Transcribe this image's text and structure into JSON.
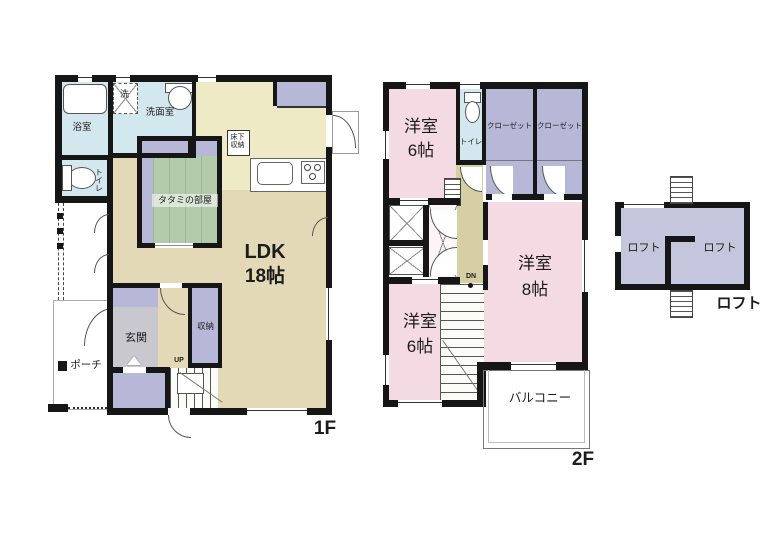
{
  "title": "floor-plan",
  "floor1": {
    "label": "1F",
    "bath": "浴室",
    "washer": "洗",
    "washroom": "洗面室",
    "toilet": "トイレ",
    "tatami_room": "タタミの部屋",
    "underfloor_line1": "床下",
    "underfloor_line2": "収納",
    "ldk": "LDK",
    "ldk_size": "18帖",
    "entrance": "玄関",
    "storage": "収納",
    "up": "UP",
    "porch": "ポーチ"
  },
  "floor2": {
    "label": "2F",
    "western_room": "洋室",
    "size_top": "6帖",
    "size_right": "8帖",
    "size_bottom": "6帖",
    "toilet": "トイレ",
    "closet": "クローゼット",
    "dn": "DN",
    "balcony": "バルコニー"
  },
  "loft": {
    "label": "ロフト",
    "room": "ロフト"
  },
  "colors": {
    "wall": "#161616",
    "water_blue": "#d3e7ee",
    "tatami_green": "#b3cbab",
    "closet_purple": "#b7b8d8",
    "ldk_tan": "#e4d9b6",
    "kitchen_pale": "#edeac5",
    "entrance_gray": "#c9c8ce",
    "bedroom_pink": "#f4dae3",
    "hall_ochre": "#d5cfa3",
    "loft_purple": "#c3c6dc"
  }
}
